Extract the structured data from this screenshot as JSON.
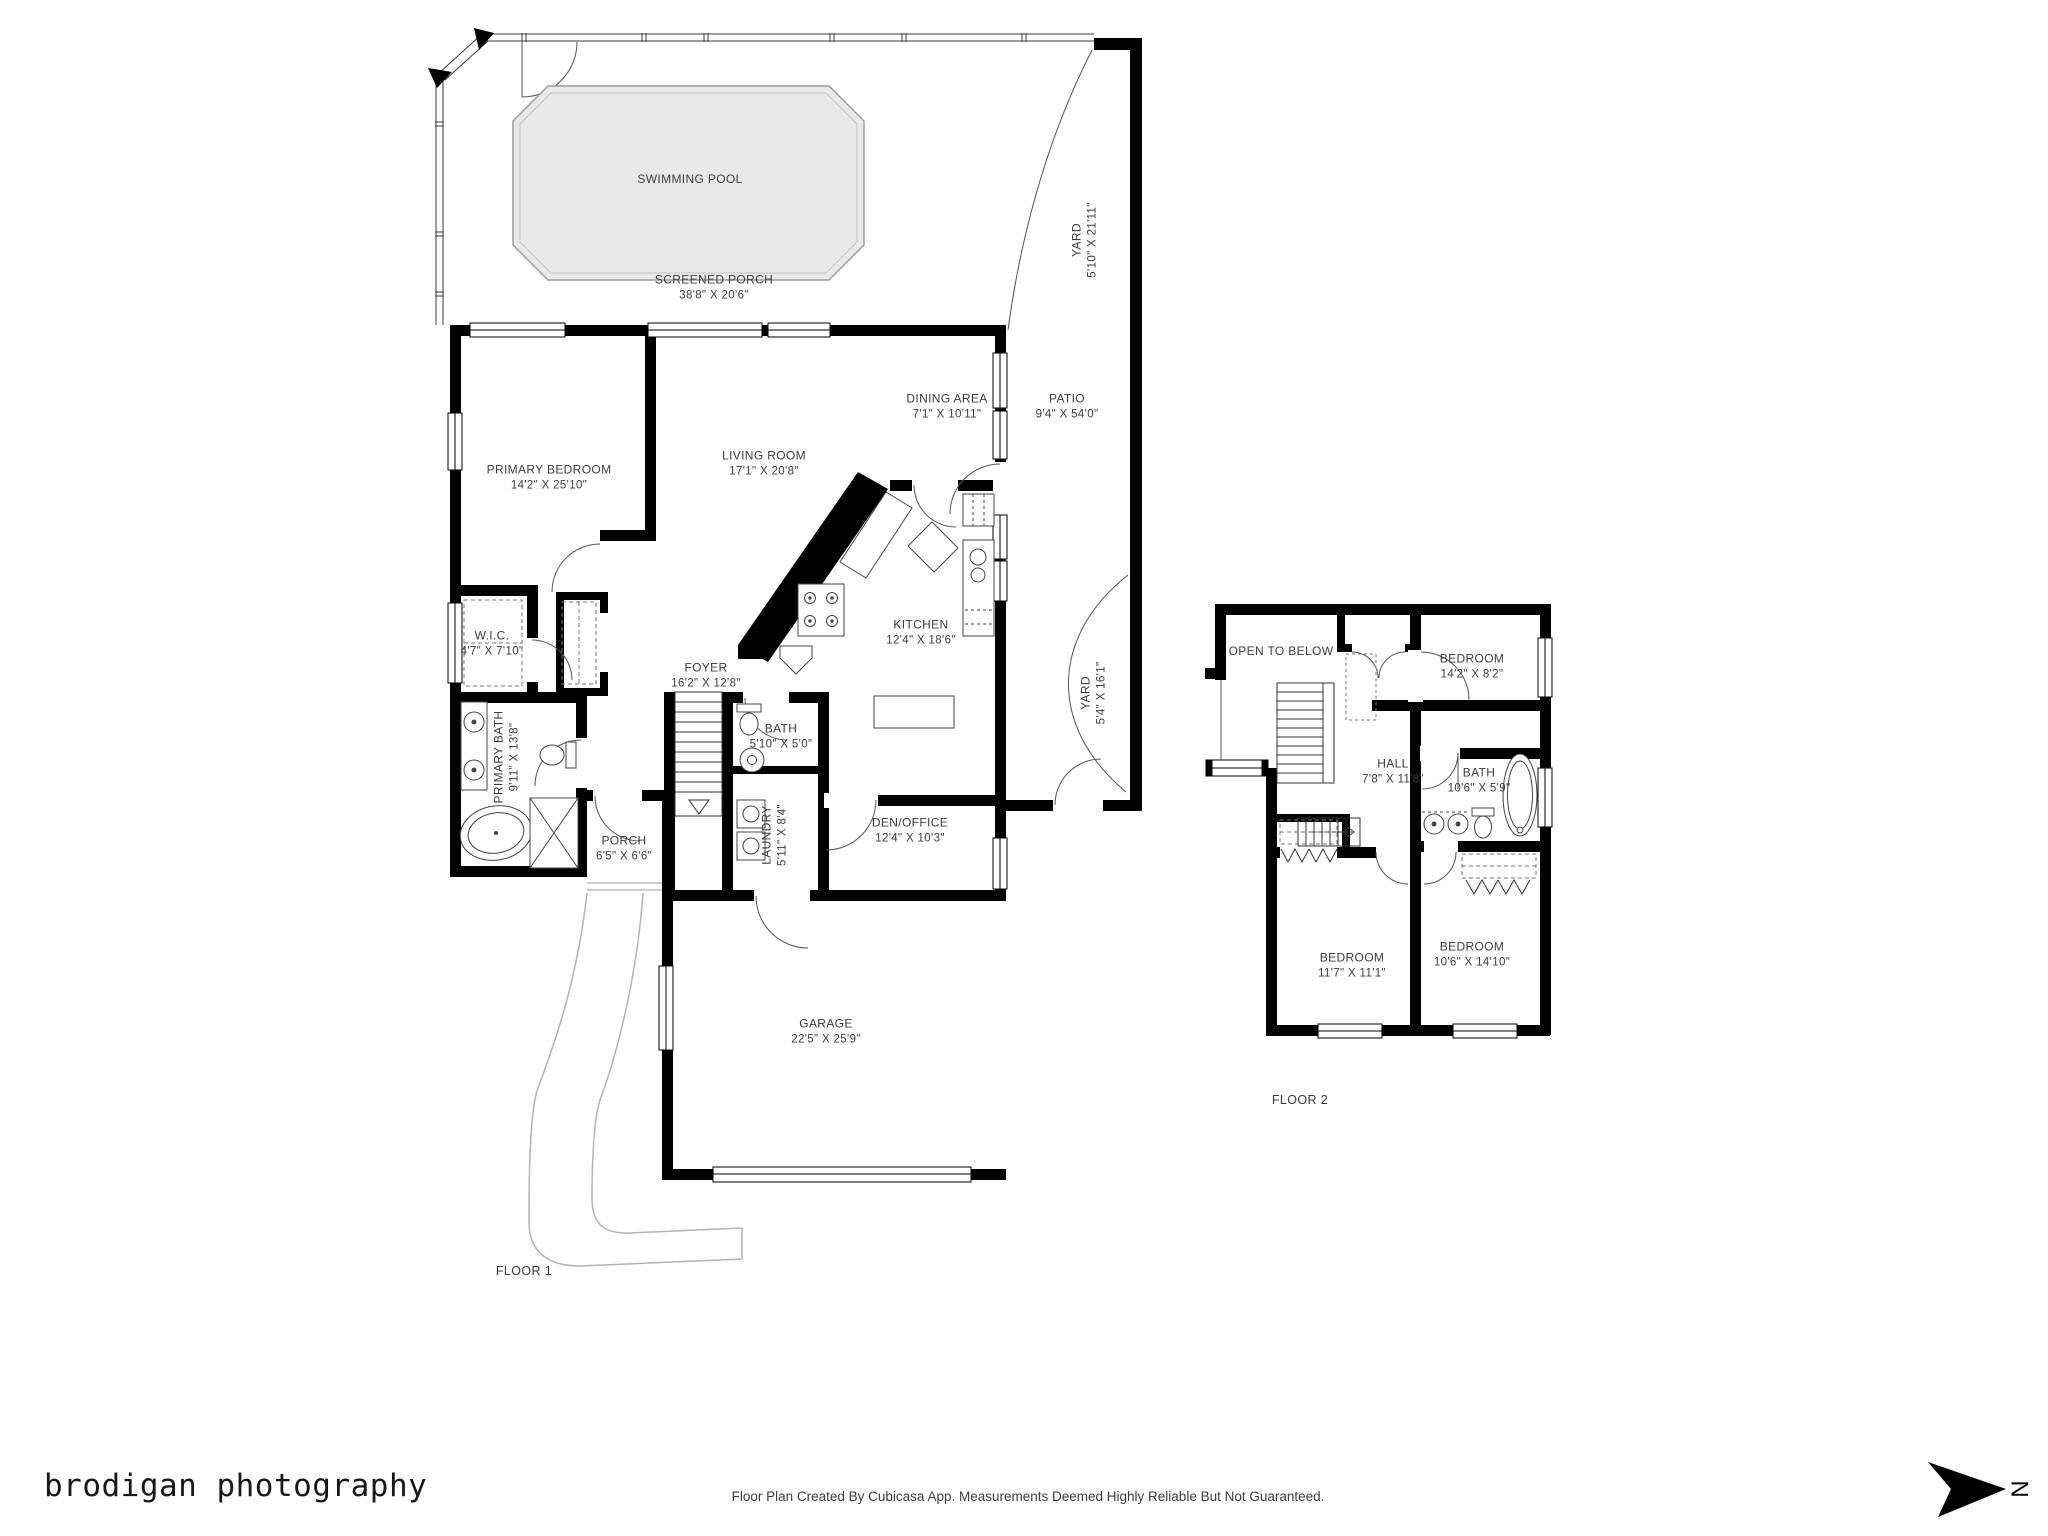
{
  "branding": {
    "studio": "brodigan photography"
  },
  "footer": {
    "disclaimer": "Floor Plan Created By Cubicasa App. Measurements Deemed Highly Reliable But Not Guaranteed."
  },
  "compass": {
    "label": "N"
  },
  "colors": {
    "wall": "#000000",
    "pool_fill": "#e9e9e9",
    "pool_stroke": "#9c9c9c",
    "label": "#3d3d3d",
    "driveway": "#b3b3b3"
  },
  "floor1": {
    "label": "FLOOR 1",
    "rooms": [
      {
        "name": "SWIMMING POOL",
        "dims": ""
      },
      {
        "name": "SCREENED PORCH",
        "dims": "38'8\" X 20'6\""
      },
      {
        "name": "YARD",
        "dims": "5'10\" X 21'11\""
      },
      {
        "name": "DINING AREA",
        "dims": "7'1\" X 10'11\""
      },
      {
        "name": "PATIO",
        "dims": "9'4\" X 54'0\""
      },
      {
        "name": "LIVING ROOM",
        "dims": "17'1\" X 20'8\""
      },
      {
        "name": "PRIMARY BEDROOM",
        "dims": "14'2\" X 25'10\""
      },
      {
        "name": "W.I.C.",
        "dims": "4'7\" X 7'10\""
      },
      {
        "name": "FOYER",
        "dims": "16'2\" X 12'8\""
      },
      {
        "name": "KITCHEN",
        "dims": "12'4\" X 18'6\""
      },
      {
        "name": "YARD",
        "dims": "5'4\" X 16'1\""
      },
      {
        "name": "PRIMARY BATH",
        "dims": "9'11\" X 13'8\""
      },
      {
        "name": "BATH",
        "dims": "5'10\" X 5'0\""
      },
      {
        "name": "LAUNDRY",
        "dims": "5'11\" X 8'4\""
      },
      {
        "name": "DEN/OFFICE",
        "dims": "12'4\" X 10'3\""
      },
      {
        "name": "PORCH",
        "dims": "6'5\" X 6'6\""
      },
      {
        "name": "GARAGE",
        "dims": "22'5\" X 25'9\""
      }
    ]
  },
  "floor2": {
    "label": "FLOOR 2",
    "rooms": [
      {
        "name": "OPEN TO BELOW",
        "dims": ""
      },
      {
        "name": "BEDROOM",
        "dims": "14'2\" X 8'2\""
      },
      {
        "name": "HALL",
        "dims": "7'8\" X 11'8\""
      },
      {
        "name": "BATH",
        "dims": "10'6\" X 5'9\""
      },
      {
        "name": "BEDROOM",
        "dims": "11'7\" X 11'1\""
      },
      {
        "name": "BEDROOM",
        "dims": "10'6\" X 14'10\""
      }
    ]
  }
}
